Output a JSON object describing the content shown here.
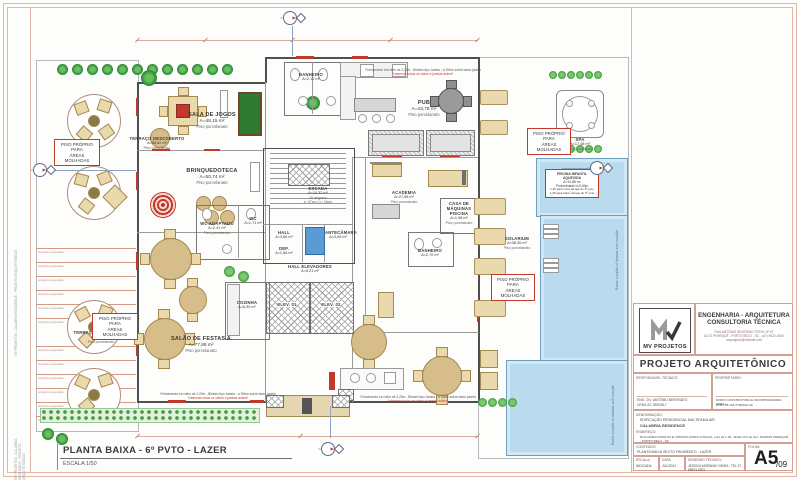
{
  "footer": {
    "title": "PLANTA BAIXA - 6º PVTO - LAZER",
    "scale": "ESCALA 1/50"
  },
  "margin_note": "MV PROJETOS - CALABRIA RESIDENCE - PROJETO ARQUITETÔNICO",
  "rooms": {
    "sala_jogos": {
      "name": "SALA DE JOGOS",
      "area": "A=48,15 m²",
      "floor": "Piso porcelanato"
    },
    "brinquedoteca": {
      "name": "BRINQUEDOTECA",
      "area": "A=50,74 m²",
      "floor": "Piso porcelanato"
    },
    "terraco_sup": {
      "name": "TERRAÇO DESCOBERTO",
      "area": "A=58,62 m²",
      "floor": "Piso porcelanato"
    },
    "terraco_inf": {
      "name": "TERRAÇO DESCOBERTO",
      "area": "A=32,80 m²",
      "floor": "Piso porcelanato"
    },
    "pub": {
      "name": "PUB",
      "area": "A=43,78 m²",
      "floor": "Piso porcelanato"
    },
    "academia": {
      "name": "ACADEMIA",
      "area": "A=27,58 m²",
      "floor": "Piso porcelanato"
    },
    "spa": {
      "name": "SPA",
      "area": "A=17,48 m²",
      "floor": "Piso porcelanato"
    },
    "solarium": {
      "name": "SOLARIUM",
      "area": "A=38,30 m²",
      "floor": "Piso porcelanato"
    },
    "salao_festas": {
      "name": "SALÃO DE FESTAS A",
      "area": "A=77,88 m²",
      "floor": "Piso porcelanato"
    },
    "cozinha": {
      "name": "COZINHA",
      "area": "A=6,30 m²"
    },
    "wc_adaptado": {
      "name": "WC ADAPTADO",
      "area": "A=2,41 m²",
      "floor": "Piso porcelanato"
    },
    "wc": {
      "name": "WC",
      "area": "A=1,71 m²"
    },
    "banheiro_sup": {
      "name": "BANHEIRO",
      "area": "A=2,12 m²"
    },
    "banheiro_academia": {
      "name": "BANHEIRO",
      "area": "A=2,70 m²"
    },
    "casa_maquinas": {
      "name": "CASA DE MÁQUINAS PISCINA",
      "area": "A=1,98 m²",
      "floor": "Piso porcelanato"
    },
    "escada": {
      "name": "ESCADA",
      "area": "A=10,32 m²",
      "note1": "20 degraus",
      "note2": "e: 27cm / p: 18cm"
    },
    "hall": {
      "name": "HALL",
      "area": "A=3,86 m²"
    },
    "dep": {
      "name": "DEP.",
      "area": "A=1,66 m²"
    },
    "antecamara": {
      "name": "ANTECÂMARA",
      "area": "A=3,06 m²"
    },
    "hall_elevadores": {
      "name": "HALL ELEVADORES",
      "area": "A=5,21 m²",
      "floor": "Piso porcelanato"
    },
    "elev1": {
      "name": "ELEV. 01"
    },
    "elev2": {
      "name": "ELEV. 02"
    },
    "piscina_infantil": {
      "name": "PISCINA INFANTIL AQUECIDA",
      "area": "A=10,88 m²",
      "note1": "Profundidade h=0,60m",
      "note2": "1,25 para cima da laje do 5º pvto",
      "note3": "1,45 para baixo da laje do 5º pvto"
    }
  },
  "annotations": {
    "piso_molhado_1": "PISO PRÓPRIO PARA",
    "piso_molhado_2": "ÁREAS MOLHADAS",
    "pergolado": "projeção pergolado",
    "ralos": "Ralos sucção c/ bomba anti sucção",
    "spec_line1": "Fechamento em vidro de 2,20m - Blindex tipo Janela - c/ 80cm sobre baixo janela",
    "spec_line2": "*observar todos os vidros e janelas acima*"
  },
  "title_block": {
    "logo_text": "MV PROJETOS",
    "company_line1": "ENGENHARIA - ARQUITETURA",
    "company_line2": "CONSULTORIA TÉCNICA",
    "company_address1": "RUA ANTÔNIO SEVERINO STEIN, Nº 67",
    "company_address2": "ALTO PEREQUÊ - PORTO BELO - SC - (47) 9622-0000",
    "company_email": "mvprojetos@hotmail.com",
    "doc_title": "PROJETO ARQUITETÔNICO",
    "resp_label": "RESPONSÁVEL TÉCNICO:",
    "resp_name": "ENG. CIV. ANTÔNIO BERTINATO",
    "resp_crea": "CREA-SC 052928-7",
    "owner_label": "PROPRIETÁRIO:",
    "owner_name": "DOMO CONSTRUTORA E INCORPORADORA EIRELI",
    "owner_cnpj": "CNPJ 08.164.678/0001-99",
    "denom_label": "DENOMINAÇÃO:",
    "denom_line1": "EDIFICAÇÃO RESIDENCIAL MULTIFAMILIAR",
    "denom_line2": "CALABRIA RESIDENCE",
    "addr_label": "ENDEREÇO:",
    "addr_value": "RUA MÁRIO PADILHA E VIRGÍNIA IZORA CHAGAS, Lote 92 e 94, Jardim Pôr do Sol - BAIRRO PEREQUÊ - PORTO BELO - SC",
    "content_label": "CONTEÚDO:",
    "content_value": "PLANTA BAIXA SEXTO PAVIMENTO - LAZER",
    "sheet_label": "FOLHA:",
    "sheet_number": "A5",
    "sheet_total": "/09",
    "scale_label": "ESCALA:",
    "scale_value": "INDICADA",
    "date_label": "DATA:",
    "date_value": "JUL/2021",
    "draft_label": "DESENHO TÉCNICO:",
    "draft_value": "JÉSSICA MORANDI VIEIRA  -  TEL 47 99823-0201"
  }
}
